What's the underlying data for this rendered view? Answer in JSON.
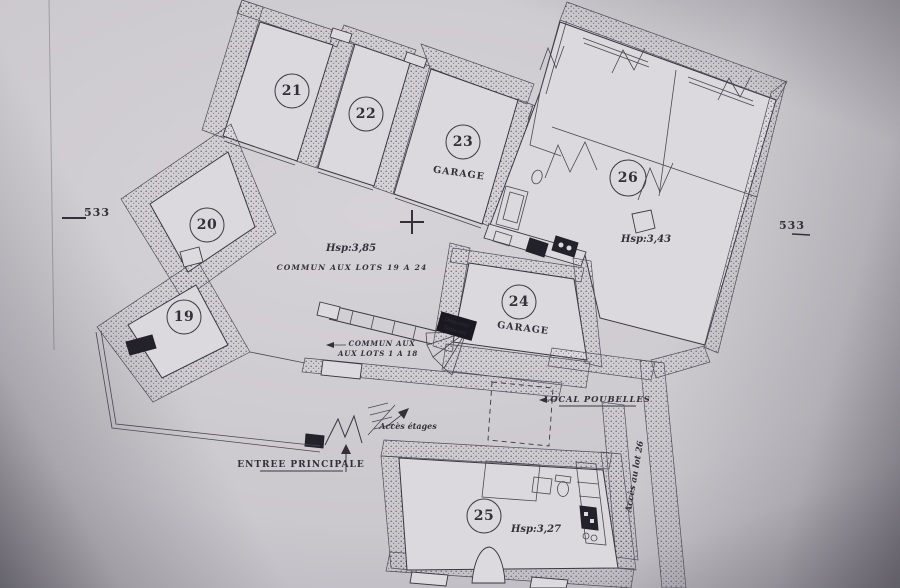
{
  "marks": {
    "left": "533",
    "right": "533"
  },
  "rooms": {
    "r19": {
      "num": "19"
    },
    "r20": {
      "num": "20"
    },
    "r21": {
      "num": "21"
    },
    "r22": {
      "num": "22"
    },
    "r23": {
      "num": "23",
      "label": "GARAGE"
    },
    "r24": {
      "num": "24",
      "label": "GARAGE"
    },
    "r25": {
      "num": "25",
      "hsp": "Hsp:3,27"
    },
    "r26": {
      "num": "26",
      "hsp": "Hsp:3,43"
    }
  },
  "annotations": {
    "hsp_courtyard": "Hsp:3,85",
    "commun_19_24": "COMMUN AUX LOTS 19 A 24",
    "commun_1_18_line1": "COMMUN AUX",
    "commun_1_18_line2": "AUX LOTS 1 A 18",
    "acces_etages": "Accès étages",
    "entree_principale": "ENTREE PRINCIPALE",
    "local_poubelles": "LOCAL POUBELLES",
    "acces_lot_26": "Accès au lot 26",
    "descente_line1": "Descente",
    "descente_line2": "Sous-sol"
  },
  "colors": {
    "ink": "#33303a",
    "paper": "#dbd9dd",
    "stipple_dot": "#5e5b66",
    "fixture": "#23212a"
  }
}
